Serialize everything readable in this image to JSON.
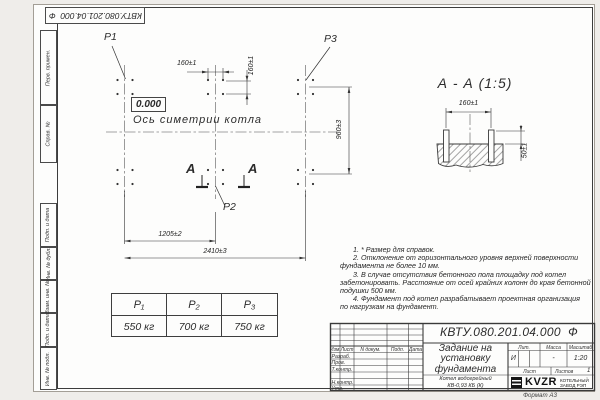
{
  "sheet": {
    "stamp_top": "КВТУ.080.201.04.000  Ф",
    "format_label": "Формат А3"
  },
  "margin": {
    "labels": [
      "Перв. примен.",
      "Справ. №",
      "Подп. и дата",
      "Инв. № дубл.",
      "Взам. инв. №",
      "Подп. и дата",
      "Инв. № подл."
    ]
  },
  "plan": {
    "p1": "P1",
    "p2": "P2",
    "p3": "P3",
    "level_mark": "0.000",
    "axis_label": "Ось симетрии котла",
    "section_letter": "А",
    "dims": {
      "spacing_h": "160±1",
      "spacing_v": "160±1",
      "width_960": "960±3",
      "half_1205": "1205±2",
      "total_2410": "2410±3"
    }
  },
  "section": {
    "title": "А - А (1:5)",
    "dims": {
      "spacing": "160±1",
      "height": "50±1"
    }
  },
  "loads_table": {
    "headers": [
      "P₁",
      "P₂",
      "P₃"
    ],
    "values": [
      "550 кг",
      "700 кг",
      "750 кг"
    ]
  },
  "notes": {
    "lines": [
      "1. * Размер для справок.",
      "2. Отклонение от горизонтального уровня верхней поверхности",
      "фундамента не более 10 мм.",
      "3. В случае отсутствия бетонного пола площадку под котел",
      "забетонировать. Расстояние от осей крайних колонн до края бетонной",
      "подушки 500 мм.",
      "4. Фундамент под котел разрабатывает проектная организация",
      "по нагрузкам на фундамент."
    ]
  },
  "title_block": {
    "doc_number": "КВТУ.080.201.04.000  Ф",
    "title_lines": [
      "Задание на",
      "установку",
      "фундамента"
    ],
    "header_cols": [
      "Изм.",
      "Лист",
      "N докум.",
      "Подп.",
      "Дата"
    ],
    "row_labels": [
      "Разраб.",
      "Пров.",
      "Т.контр.",
      "Н.контр.",
      "Утв."
    ],
    "lit_header": "Лит.",
    "mass_header": "Масса",
    "scale_header": "Масштаб",
    "lit_value": "И",
    "mass_value": "-",
    "scale_value": "1:20",
    "sheet_label": "Лист",
    "sheets_label": "Листов",
    "sheets_value": "1",
    "product_lines": [
      "Котел водогрейный",
      "КВ-0,93 КБ (К)"
    ],
    "logo_text": "KVZR",
    "logo_caption": [
      "КОТЕЛЬНЫЙ",
      "ЗАВОД РЭП"
    ]
  }
}
